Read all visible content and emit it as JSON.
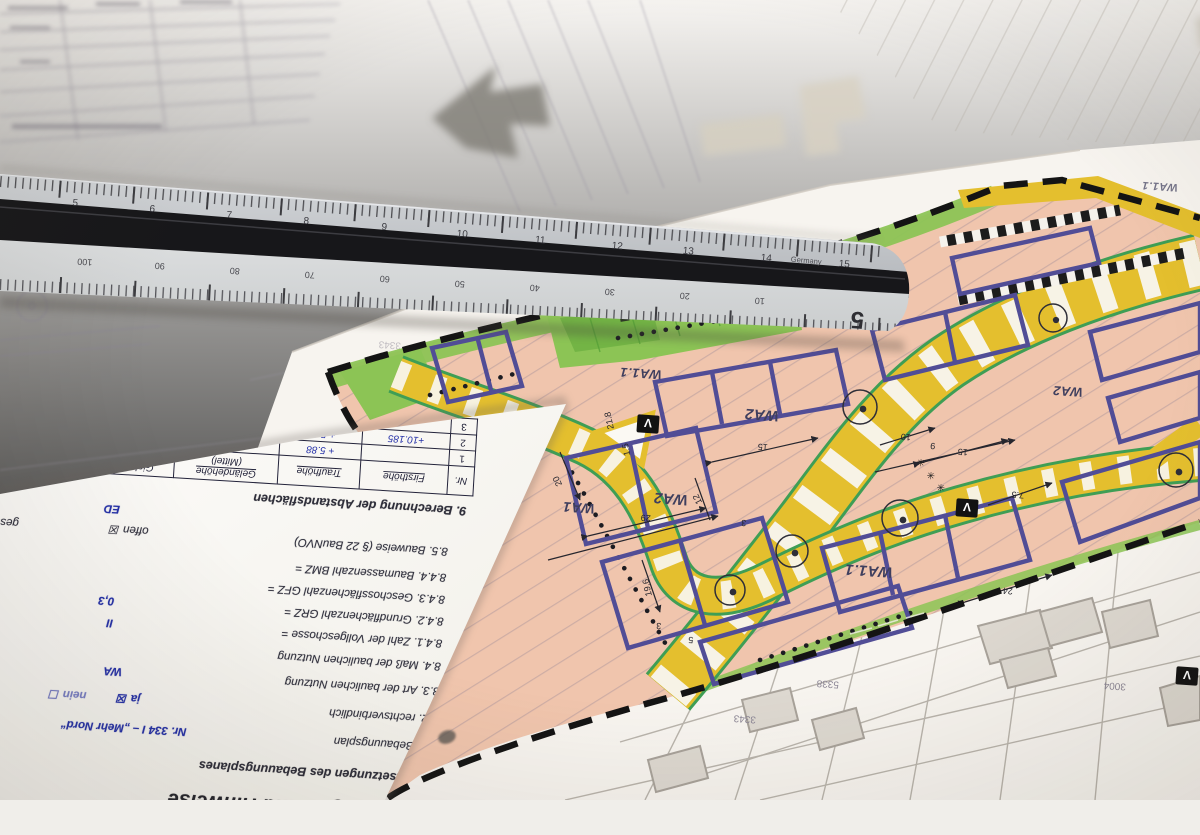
{
  "scene": "photograph of development-plan documents with scale ruler",
  "colors": {
    "plan_pink": "#f0c5ad",
    "road_yellow": "#e4bf2e",
    "green_area": "#8cc455",
    "green_line": "#3f9e55",
    "parcel_blue": "#514d96",
    "boundary_black": "#141414",
    "ruler_grey": "#c7cacc",
    "ink_blue": "#2531a8",
    "paper": "#fbfaf7"
  },
  "ruler": {
    "top_numbers": [
      "5",
      "6",
      "7",
      "8",
      "9",
      "10",
      "11",
      "12",
      "13",
      "14",
      "15"
    ],
    "brand": "Germany",
    "bottom_numbers": [
      "100",
      "90",
      "80",
      "70",
      "60",
      "50",
      "40",
      "30",
      "20",
      "10"
    ],
    "scale_digit": "5"
  },
  "map": {
    "zone_labels": [
      "WA1.1",
      "WA2",
      "WA2",
      "WA1",
      "WA1.1",
      "WA2",
      "WA1.1"
    ],
    "v": "V",
    "asterisk": "✳",
    "dims": [
      "15",
      "20",
      "29",
      "12",
      "7.5",
      "15",
      "3",
      "10",
      "9",
      "24",
      "19.6",
      "21.8",
      "1.5",
      "15",
      "3",
      "5",
      "15.3"
    ],
    "parcels": [
      "5338",
      "3004",
      "3343",
      "3645",
      "3343"
    ]
  },
  "doc": {
    "title": "Bemerkungen und Hinweise",
    "s8": "8. Festsetzungen des Bebauungsplanes",
    "s81_label": "8.1. Bebauungsplan",
    "s81_value": "Nr. 334 I – „Mehr Nord“",
    "s82_label": "8.2. rechtsverbindlich",
    "s82_ja": "ja ☒",
    "s82_nein": "nein ☐",
    "s83_label": "8.3. Art der baulichen Nutzung",
    "s83_value": "WA",
    "s84_label": "8.4. Maß der baulichen Nutzung",
    "s841_label": "8.4.1. Zahl der Vollgeschosse =",
    "s841_value": "II",
    "s841_right": "oder",
    "s842_label": "8.4.2. Grundflächenzahl GRZ =",
    "s842_value": "0,3",
    "s842_right": "oder G",
    "s843_label": "8.4.3. Geschossflächenzahl GFZ =",
    "s843_right": "oder G",
    "s844_label": "8.4.4. Baumassenzahl BMZ =",
    "s844_right": "oder Ba",
    "s85_label": "8.5. Bauweise (§ 22 BauNVO)",
    "s85_offen": "offen ☒",
    "s85_geschlossen": "geschlossen ☐",
    "ed": "ED",
    "s9": "9. Berechnung der Abstandsflächen",
    "table": {
      "h_nr": "Nr.",
      "h_first": "Firsthöhe",
      "h_trauf": "Traufhöhe",
      "h_gel1": "Geländehöhe",
      "h_gel2": "(Mittel)",
      "h_gieb1": "Giebelhöhe",
      "h_gieb2": "g",
      "h_third": "1/3 x g",
      "rows": [
        [
          "1",
          "",
          "+ 5.88",
          "0",
          "",
          ""
        ],
        [
          "2",
          "+10.185",
          "+ 5.88",
          "0",
          "4.305",
          "1.435"
        ],
        [
          "3",
          "",
          "+6.50",
          "",
          "",
          ""
        ]
      ]
    }
  }
}
